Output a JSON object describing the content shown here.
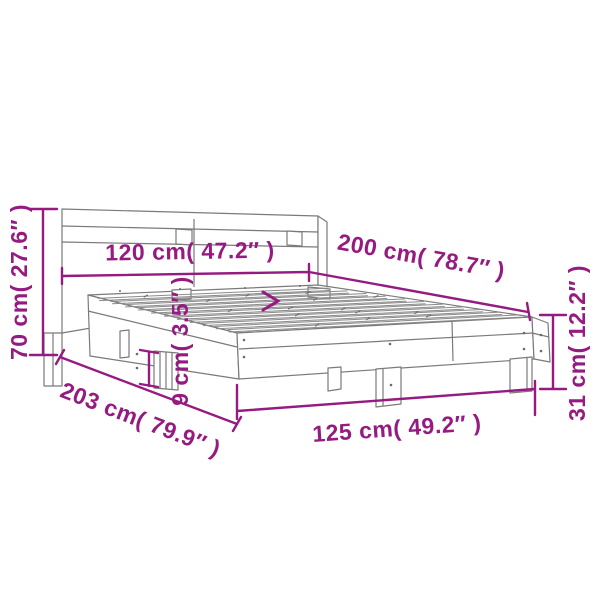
{
  "figure": {
    "type": "product-dimension-diagram",
    "subject": "bed frame with headboard and slatted base",
    "background_color": "#ffffff",
    "drawing_color": "#7a7a7a",
    "dimension_color": "#951b81"
  },
  "dimensions": {
    "headboard_height": "70 cm( 27.6″ )",
    "mattress_width": "120 cm( 47.2″ )",
    "mattress_length": "200 cm( 78.7″ )",
    "side_height": "31 cm( 12.2″ )",
    "platform_height": "9 cm( 3.5″ )",
    "total_length": "203 cm( 79.9″ )",
    "total_width": "125 cm( 49.2″ )"
  }
}
